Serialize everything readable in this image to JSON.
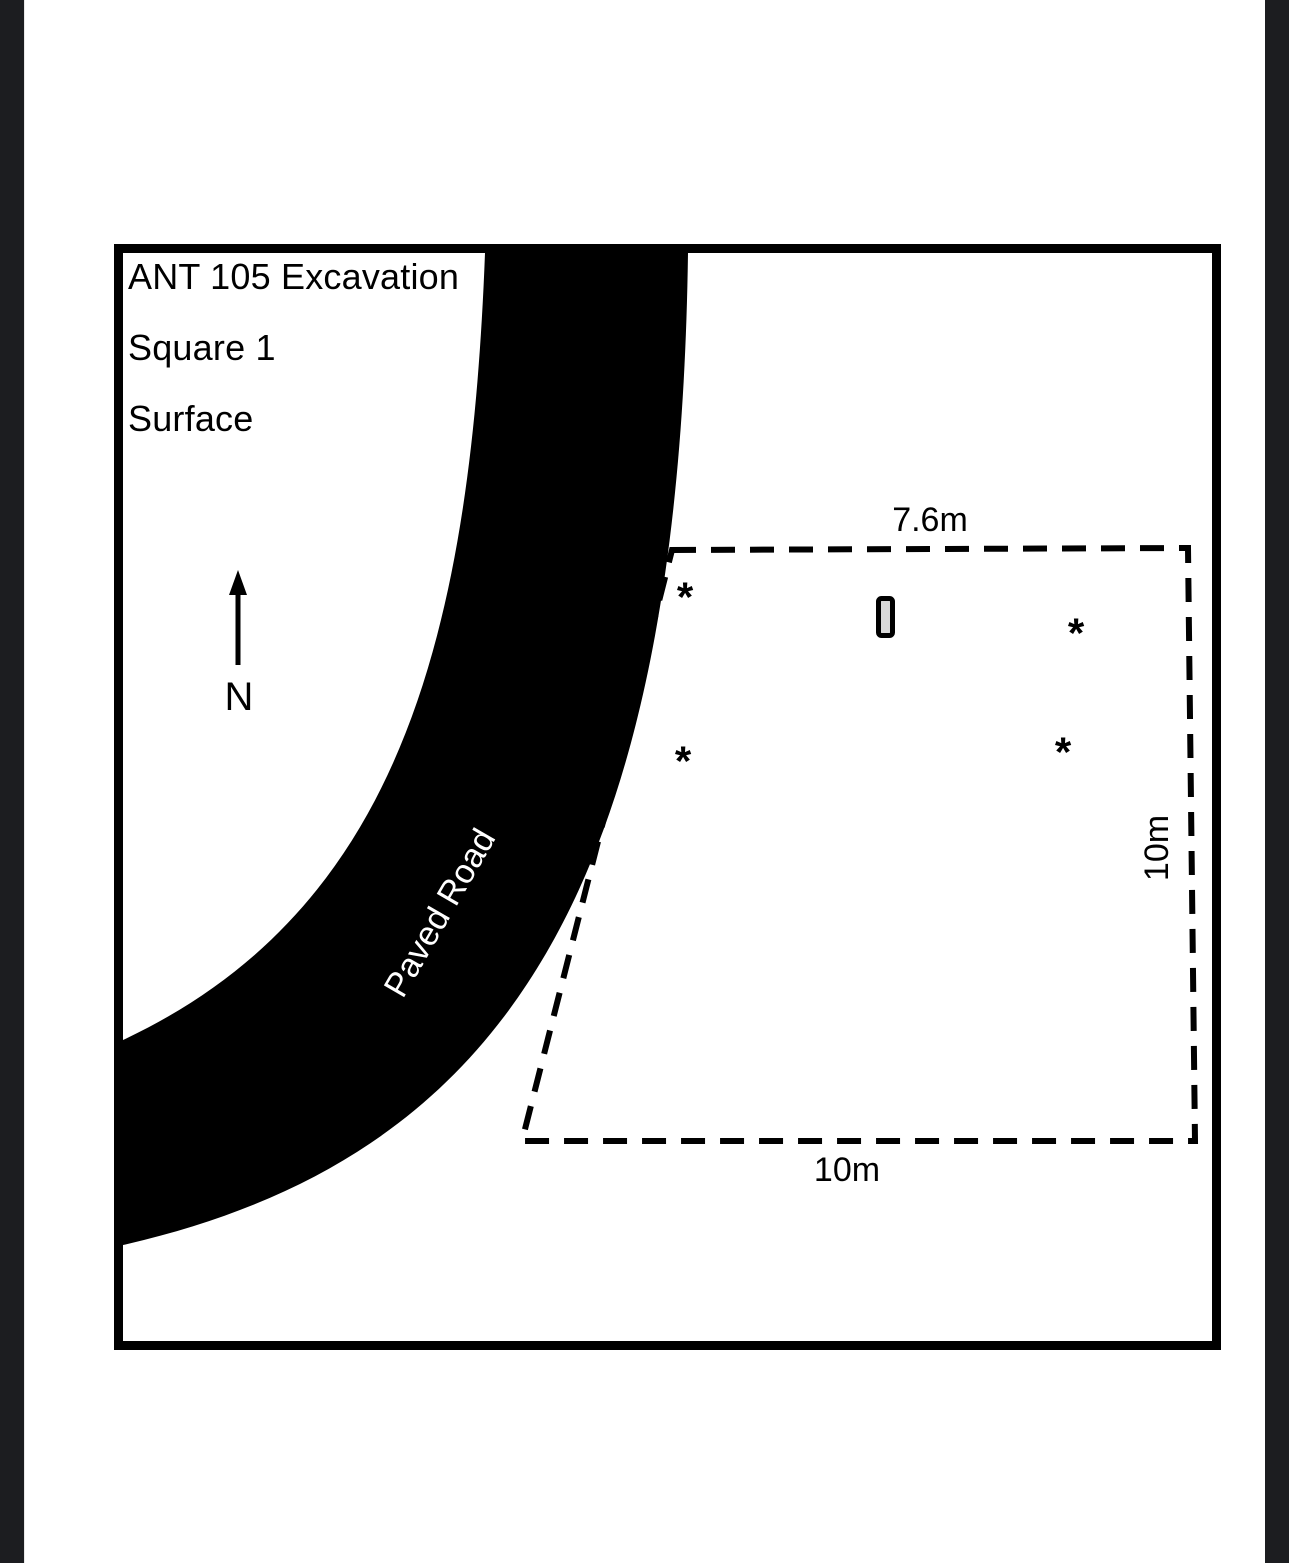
{
  "viewer": {
    "gutter_color": "#1c1d20",
    "page_color": "#ffffff"
  },
  "map": {
    "title_lines": {
      "line1": "ANT 105 Excavation",
      "line2": "Square 1",
      "line3": "Surface"
    },
    "north_label": "N",
    "road_label": "Paved Road",
    "excavation_unit": {
      "top_dim": "7.6m",
      "right_dim": "10m",
      "bottom_dim": "10m"
    },
    "markers": [
      {
        "symbol": "*"
      },
      {
        "symbol": "*"
      },
      {
        "symbol": "*"
      },
      {
        "symbol": "*"
      }
    ],
    "colors": {
      "road": "#000000",
      "outline": "#000000",
      "artifact_fill": "#d9d9d9"
    }
  }
}
